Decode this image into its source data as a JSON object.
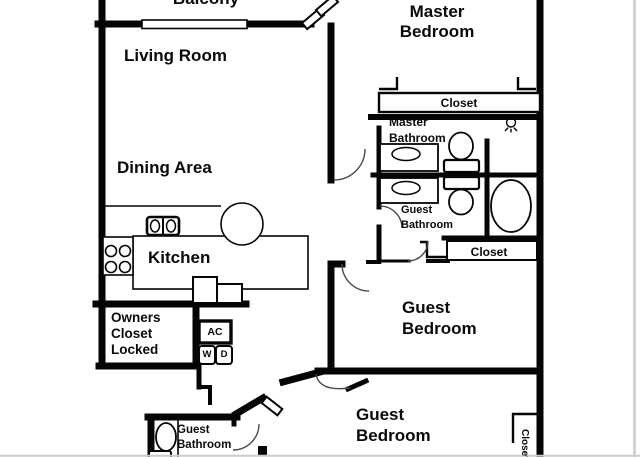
{
  "colors": {
    "walls": "#050505",
    "background": "#ffffff",
    "fixture_outline": "#1a1a1a",
    "door_arc": "#4a4a4a",
    "frame_edge": "#cccccc"
  },
  "labels": {
    "balcony": "Balcony",
    "living_room": "Living Room",
    "master_bedroom": {
      "line1": "Master",
      "line2": "Bedroom"
    },
    "master_closet": "Closet",
    "master_bathroom": {
      "line1": "Master",
      "line2": "Bathroom"
    },
    "dining_area": "Dining Area",
    "kitchen": "Kitchen",
    "guest_bathroom_mid": {
      "line1": "Guest",
      "line2": "Bathroom"
    },
    "hall_closet": "Closet",
    "guest_bedroom_mid": {
      "line1": "Guest",
      "line2": "Bedroom"
    },
    "owners_closet": {
      "line1": "Owners",
      "line2": "Closet",
      "line3": "Locked"
    },
    "ac_unit": "AC",
    "washer": "W",
    "dryer": "D",
    "guest_bathroom_bottom": {
      "line1": "Guest",
      "line2": "Bathroom"
    },
    "guest_bedroom_bottom": {
      "line1": "Guest",
      "line2": "Bedroom"
    },
    "bedroom2_closet": "Closet"
  },
  "fixtures": [
    "window",
    "sliding-glass-door",
    "kitchen-sink",
    "stove-burners",
    "kitchen-counter",
    "round-counter-end",
    "appliance",
    "bathroom-sink",
    "toilet",
    "bathtub",
    "ceiling-light",
    "washer",
    "dryer",
    "ac-unit"
  ]
}
